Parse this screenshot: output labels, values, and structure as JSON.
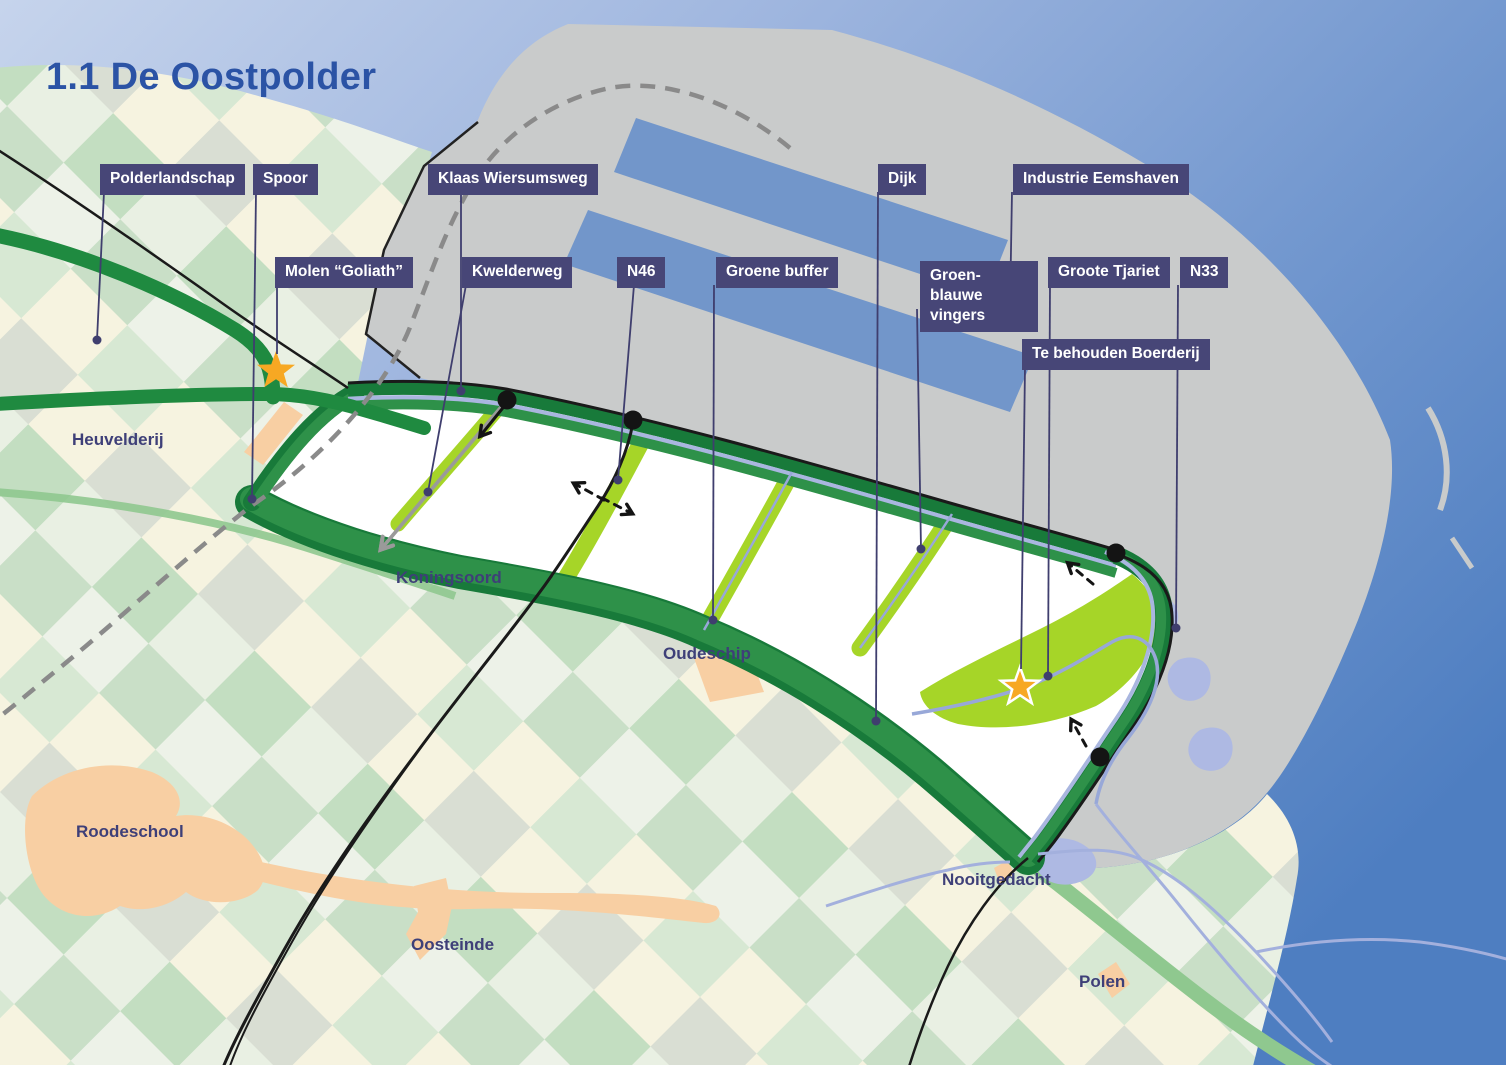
{
  "title": "1.1 De Oostpolder",
  "colors": {
    "title_text": "#2B53A5",
    "label_bg": "#474677",
    "label_text": "#FFFFFF",
    "place_text": "#3E3F78",
    "leader_line": "#3F3E6E",
    "sea_light": "#C6D4EC",
    "sea_deep": "#4E7EC1",
    "harbor_water": "#7296CA",
    "industry_gray": "#C9CBCB",
    "dike_green": "#2E9149",
    "dike_dark_green": "#187A3A",
    "road_green": "#1F8A40",
    "finger_green": "#A6D528",
    "road_green_light": "#8FC88F",
    "stream_blue": "#A3B0DD",
    "water_blob": "#AEB9E3",
    "village_orange": "#F8CFA3",
    "star_yellow": "#F7A823",
    "road_black": "#1A1A1A",
    "rail_dash_gray": "#8A8A8A",
    "kwelderweg_gray": "#9A9A9A"
  },
  "callouts": [
    {
      "id": "polderlandschap",
      "label": "Polderlandschap",
      "x": 100,
      "y": 164,
      "leader": [
        104,
        192,
        97,
        340
      ],
      "end": "dot"
    },
    {
      "id": "spoor",
      "label": "Spoor",
      "x": 253,
      "y": 164,
      "leader": [
        256,
        192,
        252,
        499
      ],
      "end": "dot"
    },
    {
      "id": "klaas-wiersumsweg",
      "label": "Klaas Wiersumsweg",
      "x": 428,
      "y": 164,
      "leader": [
        461,
        192,
        461,
        391
      ],
      "end": "dot"
    },
    {
      "id": "dijk",
      "label": "Dijk",
      "x": 878,
      "y": 164,
      "leader": [
        878,
        192,
        876,
        721
      ],
      "end": "dot"
    },
    {
      "id": "industrie-eemshaven",
      "label": "Industrie Eemshaven",
      "x": 1013,
      "y": 164,
      "leader": [
        1012,
        192,
        1010,
        308
      ],
      "end": "dot"
    },
    {
      "id": "molen-goliath",
      "label": "Molen “Goliath”",
      "x": 275,
      "y": 257,
      "leader": [
        277,
        285,
        277,
        354
      ],
      "end": "star"
    },
    {
      "id": "kwelderweg",
      "label": "Kwelderweg",
      "x": 462,
      "y": 257,
      "leader": [
        466,
        285,
        428,
        492
      ],
      "end": "dot"
    },
    {
      "id": "n46",
      "label": "N46",
      "x": 617,
      "y": 257,
      "leader": [
        634,
        285,
        618,
        480
      ],
      "end": "dot"
    },
    {
      "id": "groene-buffer",
      "label": "Groene buffer",
      "x": 716,
      "y": 257,
      "leader": [
        714,
        285,
        713,
        620
      ],
      "end": "dot"
    },
    {
      "id": "groen-blauwe-vingers",
      "label": "Groen-blauwe vingers",
      "x": 920,
      "y": 261,
      "max_w": 118,
      "leader": [
        917,
        309,
        921,
        549
      ],
      "end": "dot"
    },
    {
      "id": "groote-tjariet",
      "label": "Groote Tjariet",
      "x": 1048,
      "y": 257,
      "leader": [
        1050,
        285,
        1048,
        676
      ],
      "end": "dot"
    },
    {
      "id": "n33",
      "label": "N33",
      "x": 1180,
      "y": 257,
      "leader": [
        1178,
        285,
        1176,
        628
      ],
      "end": "dot"
    },
    {
      "id": "te-behouden-boerderij",
      "label": "Te behouden Boerderij",
      "x": 1022,
      "y": 339,
      "leader": [
        1025,
        367,
        1021,
        669
      ],
      "end": "star"
    }
  ],
  "places": [
    {
      "id": "heuvelderij",
      "label": "Heuvelderij",
      "x": 72,
      "y": 430
    },
    {
      "id": "koningsoord",
      "label": "Koningsoord",
      "x": 396,
      "y": 568
    },
    {
      "id": "oudeschip",
      "label": "Oudeschip",
      "x": 663,
      "y": 644
    },
    {
      "id": "roodeschool",
      "label": "Roodeschool",
      "x": 76,
      "y": 822
    },
    {
      "id": "oosteinde",
      "label": "Oosteinde",
      "x": 411,
      "y": 935
    },
    {
      "id": "nooitgedacht",
      "label": "Nooitgedacht",
      "x": 942,
      "y": 870
    },
    {
      "id": "polen",
      "label": "Polen",
      "x": 1079,
      "y": 972
    }
  ],
  "markers": {
    "stars": [
      {
        "id": "molen-goliath-star",
        "x": 276,
        "y": 371,
        "halo": false
      },
      {
        "id": "boerderij-star",
        "x": 1020,
        "y": 687,
        "halo": true
      }
    ],
    "entrance_dots": [
      {
        "x": 507,
        "y": 400
      },
      {
        "x": 633,
        "y": 420
      },
      {
        "x": 1116,
        "y": 553
      },
      {
        "x": 1100,
        "y": 757
      }
    ]
  },
  "arrows": [
    {
      "id": "kwelderweg-direction-arrow",
      "x1": 507,
      "y1": 400,
      "x2": 382,
      "y2": 548,
      "style": "solid",
      "color": "gray",
      "width": 3.5
    },
    {
      "id": "entrance-west-arrow",
      "x1": 506,
      "y1": 404,
      "x2": 481,
      "y2": 435,
      "style": "solid",
      "color": "black",
      "width": 3
    },
    {
      "id": "crossing-west-arrow",
      "x1": 604,
      "y1": 500,
      "x2": 575,
      "y2": 484,
      "style": "dashed",
      "color": "black",
      "width": 3
    },
    {
      "id": "crossing-east-arrow",
      "x1": 602,
      "y1": 498,
      "x2": 631,
      "y2": 513,
      "style": "dashed",
      "color": "black",
      "width": 3
    },
    {
      "id": "entrance-northeast-arrow",
      "x1": 1093,
      "y1": 584,
      "x2": 1069,
      "y2": 564,
      "style": "dashed",
      "color": "black",
      "width": 3
    },
    {
      "id": "entrance-southeast-arrow",
      "x1": 1086,
      "y1": 746,
      "x2": 1072,
      "y2": 721,
      "style": "dashed",
      "color": "black",
      "width": 3
    }
  ]
}
